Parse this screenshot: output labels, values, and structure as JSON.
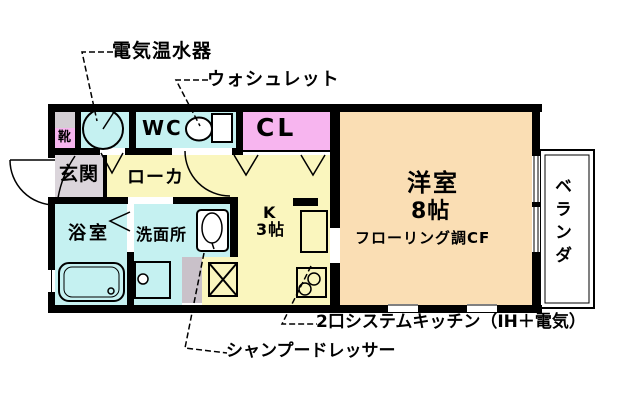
{
  "callouts": {
    "electric_water_heater": "電気温水器",
    "washlet": "ウォシュレット",
    "system_kitchen": "2口システムキッチン（IH＋電気）",
    "shampoo_dresser": "シャンプードレッサー"
  },
  "rooms": {
    "shoes": "靴",
    "wc": "WC",
    "closet": "CL",
    "entrance": "玄関",
    "corridor": "ローカ",
    "bathroom": "浴室",
    "washroom": "洗面所",
    "kitchen_label": "K",
    "kitchen_size": "3帖",
    "western_room": "洋室",
    "western_room_size": "8帖",
    "western_room_floor": "フローリング調CF",
    "veranda": "ベランダ"
  },
  "colors": {
    "room_cyan": "#C5F1F1",
    "room_pink": "#F7B5EF",
    "room_yellow": "#FAF6BE",
    "room_peach": "#FADEB4",
    "entrance_gray": "#DBD5DB",
    "cabinet_gray": "#D4CED4",
    "column_gray": "#C9C1C9",
    "wall_black": "#000000",
    "background": "#FFFFFF"
  }
}
